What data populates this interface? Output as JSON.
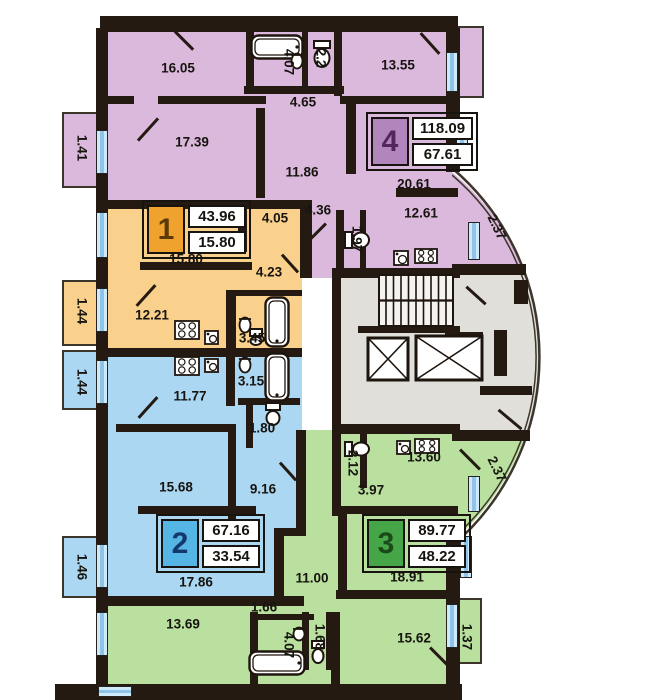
{
  "colors": {
    "wall": "#241a12",
    "apartment1_fill": "#f9d18c",
    "apartment2_fill": "#abd7f2",
    "apartment3_fill": "#b9e09e",
    "apartment4_fill": "#dab9dd",
    "core_fill": "#e0dfda",
    "window_fill": "#cde9fa",
    "window_bar": "#8fc4e8",
    "badge1_square": "#f0a22e",
    "badge1_numeral": "#5b3a06",
    "badge2_square": "#55b5e5",
    "badge2_numeral": "#14386b",
    "badge3_square": "#46a546",
    "badge3_numeral": "#1a4a1a",
    "badge4_square": "#b286bd",
    "badge4_numeral": "#552560"
  },
  "apartments": [
    {
      "id": "1",
      "badge": {
        "number": "1",
        "total_area": "43.96",
        "living_area": "15.80",
        "x": 142,
        "y": 200
      },
      "labels": [
        {
          "t": "4.05",
          "x": 275,
          "y": 218,
          "r": 0
        },
        {
          "t": "15.80",
          "x": 186,
          "y": 259,
          "r": 0
        },
        {
          "t": "4.23",
          "x": 269,
          "y": 272,
          "r": 0
        },
        {
          "t": "1.44",
          "x": 82,
          "y": 311,
          "r": 90
        },
        {
          "t": "12.21",
          "x": 152,
          "y": 315,
          "r": 0
        },
        {
          "t": "3.45",
          "x": 252,
          "y": 338,
          "r": 0
        }
      ]
    },
    {
      "id": "2",
      "badge": {
        "number": "2",
        "total_area": "67.16",
        "living_area": "33.54",
        "x": 156,
        "y": 514
      },
      "labels": [
        {
          "t": "1.44",
          "x": 82,
          "y": 382,
          "r": 90
        },
        {
          "t": "11.77",
          "x": 190,
          "y": 396,
          "r": 0
        },
        {
          "t": "3.15",
          "x": 251,
          "y": 381,
          "r": 0
        },
        {
          "t": "1.80",
          "x": 262,
          "y": 428,
          "r": 0
        },
        {
          "t": "15.68",
          "x": 176,
          "y": 487,
          "r": 0
        },
        {
          "t": "9.16",
          "x": 263,
          "y": 489,
          "r": 0
        },
        {
          "t": "1.46",
          "x": 82,
          "y": 567,
          "r": 90
        },
        {
          "t": "17.86",
          "x": 196,
          "y": 582,
          "r": 0
        }
      ]
    },
    {
      "id": "3",
      "badge": {
        "number": "3",
        "total_area": "89.77",
        "living_area": "48.22",
        "x": 362,
        "y": 514
      },
      "labels": [
        {
          "t": "2.12",
          "x": 353,
          "y": 463,
          "r": 90
        },
        {
          "t": "13.60",
          "x": 424,
          "y": 457,
          "r": 0
        },
        {
          "t": "3.97",
          "x": 371,
          "y": 490,
          "r": 0
        },
        {
          "t": "2.37",
          "x": 497,
          "y": 469,
          "r": 64
        },
        {
          "t": "11.00",
          "x": 312,
          "y": 578,
          "r": 0
        },
        {
          "t": "18.91",
          "x": 407,
          "y": 577,
          "r": 0
        },
        {
          "t": "1.66",
          "x": 264,
          "y": 607,
          "r": 0
        },
        {
          "t": "13.69",
          "x": 183,
          "y": 624,
          "r": 0
        },
        {
          "t": "4.07",
          "x": 289,
          "y": 645,
          "r": 90
        },
        {
          "t": "1.68",
          "x": 320,
          "y": 637,
          "r": 90
        },
        {
          "t": "15.62",
          "x": 414,
          "y": 638,
          "r": 0
        },
        {
          "t": "1.37",
          "x": 467,
          "y": 637,
          "r": 90
        }
      ]
    },
    {
      "id": "4",
      "badge": {
        "number": "4",
        "total_area": "118.09",
        "living_area": "67.61",
        "x": 366,
        "y": 112
      },
      "labels": [
        {
          "t": "16.05",
          "x": 178,
          "y": 68,
          "r": 0
        },
        {
          "t": "4.07",
          "x": 289,
          "y": 62,
          "r": 90
        },
        {
          "t": "2.2",
          "x": 321,
          "y": 58,
          "r": 90
        },
        {
          "t": "13.55",
          "x": 398,
          "y": 65,
          "r": 0
        },
        {
          "t": "4.65",
          "x": 303,
          "y": 102,
          "r": 0
        },
        {
          "t": "1.41",
          "x": 82,
          "y": 148,
          "r": 90
        },
        {
          "t": "17.39",
          "x": 192,
          "y": 142,
          "r": 0
        },
        {
          "t": "11.86",
          "x": 302,
          "y": 172,
          "r": 0
        },
        {
          "t": "20.61",
          "x": 414,
          "y": 184,
          "r": 0
        },
        {
          "t": "4.36",
          "x": 318,
          "y": 210,
          "r": 0
        },
        {
          "t": "12.61",
          "x": 421,
          "y": 213,
          "r": 0
        },
        {
          "t": "1.97",
          "x": 357,
          "y": 239,
          "r": 90
        },
        {
          "t": "2.37",
          "x": 497,
          "y": 227,
          "r": 64
        }
      ]
    }
  ],
  "plan": {
    "icons": [
      {
        "name": "bathtub-icon",
        "type": "bathtub",
        "x": 250,
        "y": 34,
        "w": 54,
        "h": 26
      },
      {
        "name": "bathtub-icon",
        "type": "bathtub",
        "x": 264,
        "y": 296,
        "w": 26,
        "h": 52
      },
      {
        "name": "bathtub-icon",
        "type": "bathtub",
        "x": 264,
        "y": 352,
        "w": 26,
        "h": 50
      },
      {
        "name": "bathtub-icon",
        "type": "bathtub",
        "x": 248,
        "y": 650,
        "w": 58,
        "h": 26
      },
      {
        "name": "toilet-icon",
        "type": "toilet",
        "x": 312,
        "y": 40,
        "w": 20,
        "h": 28,
        "dir": "down"
      },
      {
        "name": "toilet-icon",
        "type": "toilet",
        "x": 344,
        "y": 230,
        "w": 26,
        "h": 20,
        "dir": "right"
      },
      {
        "name": "toilet-icon",
        "type": "toilet",
        "x": 248,
        "y": 328,
        "w": 16,
        "h": 18,
        "dir": "down"
      },
      {
        "name": "toilet-icon",
        "type": "toilet",
        "x": 264,
        "y": 402,
        "w": 18,
        "h": 24,
        "dir": "down"
      },
      {
        "name": "toilet-icon",
        "type": "toilet",
        "x": 344,
        "y": 440,
        "w": 26,
        "h": 18,
        "dir": "right"
      },
      {
        "name": "toilet-icon",
        "type": "toilet",
        "x": 310,
        "y": 640,
        "w": 16,
        "h": 24,
        "dir": "down"
      },
      {
        "name": "bath-sink-icon",
        "type": "sink",
        "x": 290,
        "y": 52,
        "w": 14,
        "h": 18
      },
      {
        "name": "bath-sink-icon",
        "type": "sink",
        "x": 238,
        "y": 316,
        "w": 14,
        "h": 18
      },
      {
        "name": "bath-sink-icon",
        "type": "sink",
        "x": 238,
        "y": 356,
        "w": 14,
        "h": 18
      },
      {
        "name": "bath-sink-icon",
        "type": "sink",
        "x": 292,
        "y": 626,
        "w": 14,
        "h": 16
      },
      {
        "name": "kitchen-sink-icon",
        "type": "ksink",
        "x": 393,
        "y": 250,
        "w": 16,
        "h": 16
      },
      {
        "name": "stove-icon",
        "type": "stove",
        "x": 414,
        "y": 248,
        "w": 24,
        "h": 16
      },
      {
        "name": "stove-icon",
        "type": "stove",
        "x": 174,
        "y": 320,
        "w": 26,
        "h": 20
      },
      {
        "name": "kitchen-sink-icon",
        "type": "ksink",
        "x": 204,
        "y": 330,
        "w": 15,
        "h": 15
      },
      {
        "name": "stove-icon",
        "type": "stove",
        "x": 174,
        "y": 356,
        "w": 26,
        "h": 20
      },
      {
        "name": "kitchen-sink-icon",
        "type": "ksink",
        "x": 204,
        "y": 358,
        "w": 15,
        "h": 15
      },
      {
        "name": "kitchen-sink-icon",
        "type": "ksink",
        "x": 396,
        "y": 440,
        "w": 15,
        "h": 15
      },
      {
        "name": "stove-icon",
        "type": "stove",
        "x": 414,
        "y": 438,
        "w": 26,
        "h": 16
      },
      {
        "name": "stairs-icon",
        "type": "stairs",
        "x": 378,
        "y": 274,
        "w": 76,
        "h": 53
      },
      {
        "name": "elevator-icon",
        "type": "elevator",
        "x": 366,
        "y": 336,
        "w": 44,
        "h": 46
      },
      {
        "name": "elevator-icon",
        "type": "elevator",
        "x": 414,
        "y": 334,
        "w": 70,
        "h": 48
      }
    ],
    "windows": [
      {
        "x": 96,
        "y": 130,
        "w": 12,
        "h": 44,
        "o": "v"
      },
      {
        "x": 96,
        "y": 212,
        "w": 12,
        "h": 46,
        "o": "v"
      },
      {
        "x": 96,
        "y": 288,
        "w": 12,
        "h": 44,
        "o": "v"
      },
      {
        "x": 96,
        "y": 360,
        "w": 12,
        "h": 44,
        "o": "v"
      },
      {
        "x": 96,
        "y": 544,
        "w": 12,
        "h": 44,
        "o": "v"
      },
      {
        "x": 96,
        "y": 612,
        "w": 12,
        "h": 44,
        "o": "v"
      },
      {
        "x": 446,
        "y": 52,
        "w": 12,
        "h": 40,
        "o": "v"
      },
      {
        "x": 456,
        "y": 120,
        "w": 12,
        "h": 46,
        "o": "v"
      },
      {
        "x": 468,
        "y": 222,
        "w": 12,
        "h": 38,
        "o": "v"
      },
      {
        "x": 468,
        "y": 476,
        "w": 12,
        "h": 36,
        "o": "v"
      },
      {
        "x": 460,
        "y": 536,
        "w": 12,
        "h": 42,
        "o": "v"
      },
      {
        "x": 446,
        "y": 604,
        "w": 12,
        "h": 44,
        "o": "v"
      },
      {
        "x": 98,
        "y": 686,
        "w": 34,
        "h": 11,
        "o": "h"
      }
    ],
    "doors": [
      {
        "x": 148,
        "y": 128,
        "l": 30,
        "d": -48
      },
      {
        "x": 184,
        "y": 39,
        "l": 26,
        "d": 45
      },
      {
        "x": 430,
        "y": 42,
        "l": 28,
        "d": 48
      },
      {
        "x": 316,
        "y": 232,
        "l": 28,
        "d": -45
      },
      {
        "x": 290,
        "y": 262,
        "l": 24,
        "d": 48
      },
      {
        "x": 146,
        "y": 294,
        "l": 28,
        "d": -48
      },
      {
        "x": 148,
        "y": 406,
        "l": 28,
        "d": -48
      },
      {
        "x": 288,
        "y": 470,
        "l": 24,
        "d": 48
      },
      {
        "x": 470,
        "y": 458,
        "l": 28,
        "d": 45
      },
      {
        "x": 476,
        "y": 294,
        "l": 26,
        "d": 42
      },
      {
        "x": 440,
        "y": 656,
        "l": 28,
        "d": 45
      },
      {
        "x": 510,
        "y": 418,
        "l": 30,
        "d": 40
      }
    ]
  }
}
